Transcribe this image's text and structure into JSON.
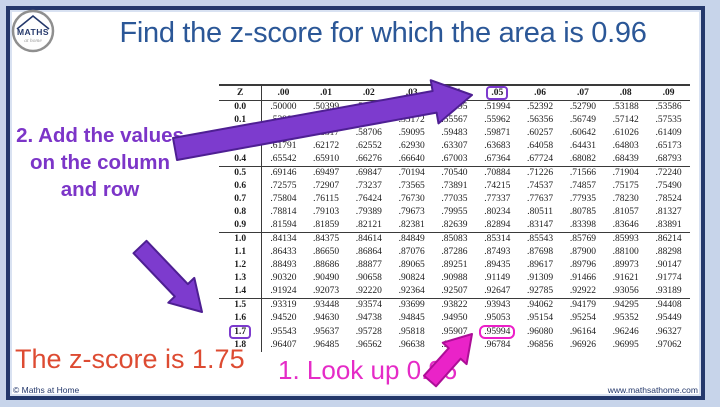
{
  "slide": {
    "title": "Find the z-score for which the area is 0.96",
    "logo": {
      "line1": "MATHS",
      "line2": "at home"
    },
    "footer_left": "© Maths at Home",
    "footer_right": "www.mathsathome.com"
  },
  "annotations": {
    "step1": "1. Look up 0.96",
    "step2": "2. Add the values on the column and row",
    "result": "The z-score is 1.75"
  },
  "colors": {
    "title_blue": "#2B5797",
    "navy": "#24386B",
    "purple_text": "#7C35C8",
    "purple_fill": "#7D3BCE",
    "purple_stroke": "#4E1F93",
    "magenta_text": "#E52BC7",
    "magenta_fill": "#EA23C8",
    "magenta_stroke": "#AD0E97",
    "red": "#DD4B32"
  },
  "ztable": {
    "col_headers": [
      "Z",
      ".00",
      ".01",
      ".02",
      ".03",
      ".04",
      ".05",
      ".06",
      ".07",
      ".08",
      ".09"
    ],
    "rows": [
      {
        "z": "0.0",
        "values": [
          ".50000",
          ".50399",
          ".50798",
          ".51197",
          ".51595",
          ".51994",
          ".52392",
          ".52790",
          ".53188",
          ".53586"
        ]
      },
      {
        "z": "0.1",
        "values": [
          ".53983",
          ".54380",
          ".54776",
          ".55172",
          ".55567",
          ".55962",
          ".56356",
          ".56749",
          ".57142",
          ".57535"
        ]
      },
      {
        "z": "0.2",
        "values": [
          ".57926",
          ".58317",
          ".58706",
          ".59095",
          ".59483",
          ".59871",
          ".60257",
          ".60642",
          ".61026",
          ".61409"
        ]
      },
      {
        "z": "0.3",
        "values": [
          ".61791",
          ".62172",
          ".62552",
          ".62930",
          ".63307",
          ".63683",
          ".64058",
          ".64431",
          ".64803",
          ".65173"
        ]
      },
      {
        "z": "0.4",
        "values": [
          ".65542",
          ".65910",
          ".66276",
          ".66640",
          ".67003",
          ".67364",
          ".67724",
          ".68082",
          ".68439",
          ".68793"
        ]
      },
      {
        "z": "0.5",
        "values": [
          ".69146",
          ".69497",
          ".69847",
          ".70194",
          ".70540",
          ".70884",
          ".71226",
          ".71566",
          ".71904",
          ".72240"
        ]
      },
      {
        "z": "0.6",
        "values": [
          ".72575",
          ".72907",
          ".73237",
          ".73565",
          ".73891",
          ".74215",
          ".74537",
          ".74857",
          ".75175",
          ".75490"
        ]
      },
      {
        "z": "0.7",
        "values": [
          ".75804",
          ".76115",
          ".76424",
          ".76730",
          ".77035",
          ".77337",
          ".77637",
          ".77935",
          ".78230",
          ".78524"
        ]
      },
      {
        "z": "0.8",
        "values": [
          ".78814",
          ".79103",
          ".79389",
          ".79673",
          ".79955",
          ".80234",
          ".80511",
          ".80785",
          ".81057",
          ".81327"
        ]
      },
      {
        "z": "0.9",
        "values": [
          ".81594",
          ".81859",
          ".82121",
          ".82381",
          ".82639",
          ".82894",
          ".83147",
          ".83398",
          ".83646",
          ".83891"
        ]
      },
      {
        "z": "1.0",
        "values": [
          ".84134",
          ".84375",
          ".84614",
          ".84849",
          ".85083",
          ".85314",
          ".85543",
          ".85769",
          ".85993",
          ".86214"
        ]
      },
      {
        "z": "1.1",
        "values": [
          ".86433",
          ".86650",
          ".86864",
          ".87076",
          ".87286",
          ".87493",
          ".87698",
          ".87900",
          ".88100",
          ".88298"
        ]
      },
      {
        "z": "1.2",
        "values": [
          ".88493",
          ".88686",
          ".88877",
          ".89065",
          ".89251",
          ".89435",
          ".89617",
          ".89796",
          ".89973",
          ".90147"
        ]
      },
      {
        "z": "1.3",
        "values": [
          ".90320",
          ".90490",
          ".90658",
          ".90824",
          ".90988",
          ".91149",
          ".91309",
          ".91466",
          ".91621",
          ".91774"
        ]
      },
      {
        "z": "1.4",
        "values": [
          ".91924",
          ".92073",
          ".92220",
          ".92364",
          ".92507",
          ".92647",
          ".92785",
          ".92922",
          ".93056",
          ".93189"
        ]
      },
      {
        "z": "1.5",
        "values": [
          ".93319",
          ".93448",
          ".93574",
          ".93699",
          ".93822",
          ".93943",
          ".94062",
          ".94179",
          ".94295",
          ".94408"
        ]
      },
      {
        "z": "1.6",
        "values": [
          ".94520",
          ".94630",
          ".94738",
          ".94845",
          ".94950",
          ".95053",
          ".95154",
          ".95254",
          ".95352",
          ".95449"
        ]
      },
      {
        "z": "1.7",
        "values": [
          ".95543",
          ".95637",
          ".95728",
          ".95818",
          ".95907",
          ".95994",
          ".96080",
          ".96164",
          ".96246",
          ".96327"
        ]
      },
      {
        "z": "1.8",
        "values": [
          ".96407",
          ".96485",
          ".96562",
          ".96638",
          ".96712",
          ".96784",
          ".96856",
          ".96926",
          ".96995",
          ".97062"
        ]
      }
    ],
    "highlights": {
      "column_header": ".05",
      "row_label": "1.7",
      "cell_value": ".95994"
    }
  }
}
